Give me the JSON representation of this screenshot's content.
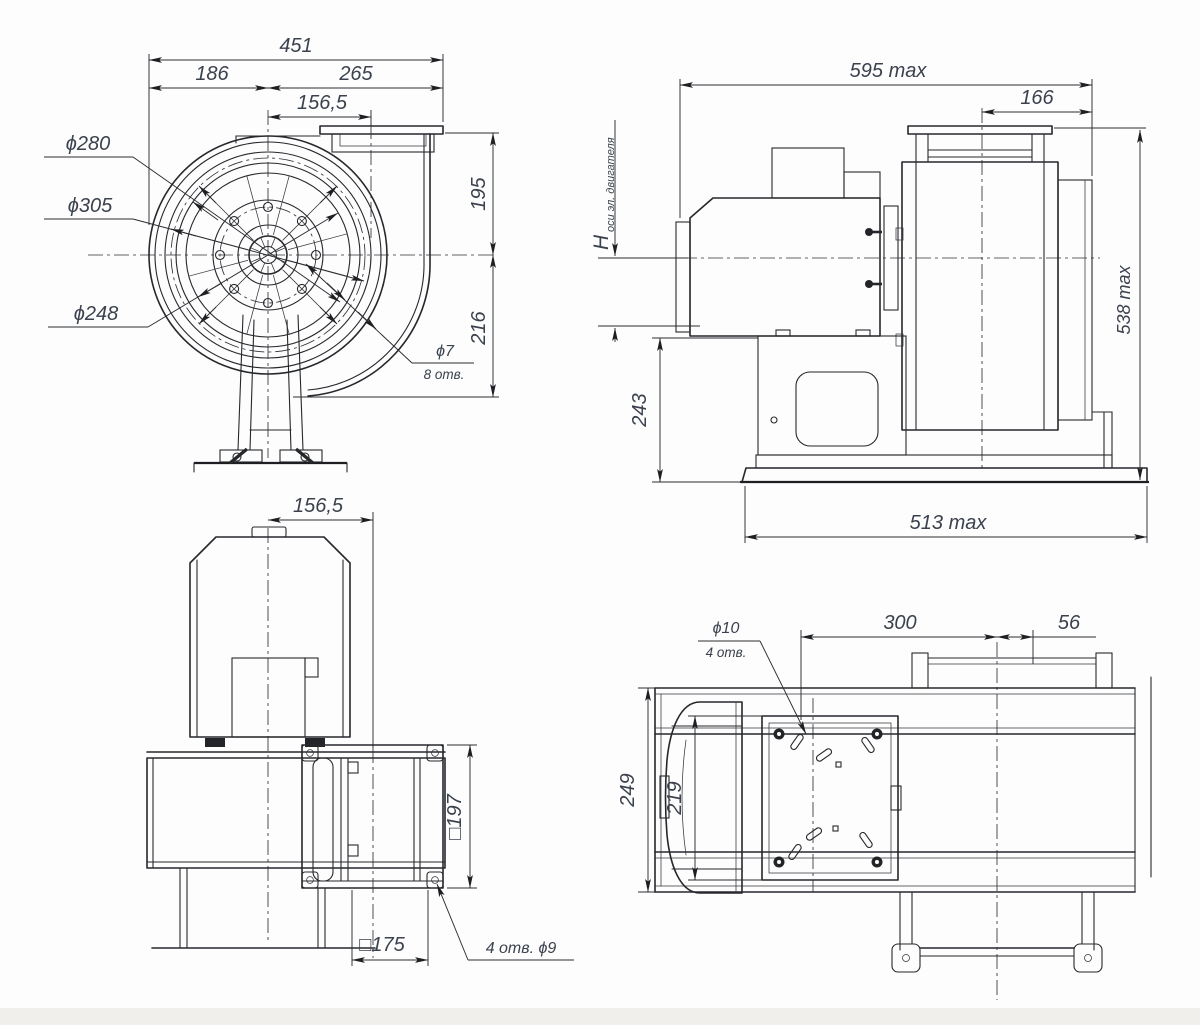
{
  "drawing": {
    "type": "fan-dimensional-drawing",
    "colors": {
      "line": "#26282c",
      "dim_text": "#3b414d",
      "background": "#fdfdfd",
      "footer": "#f0efec"
    },
    "views": {
      "front": {
        "dims": {
          "total_width": "451",
          "left_width": "186",
          "right_width": "265",
          "outlet_offset": "156,5",
          "d280": "ϕ280",
          "d305": "ϕ305",
          "d248": "ϕ248",
          "height_top": "195",
          "height_bottom": "216",
          "holes_d": "ϕ7",
          "holes_n": "8 отв."
        }
      },
      "side": {
        "dims": {
          "length_max": "595 max",
          "inlet_offset": "166",
          "axis_height_symbol": "H",
          "axis_height_sub": "оси эл. двигателя",
          "base_height": "243",
          "height_max": "538 max",
          "base_length": "513 max"
        }
      },
      "back": {
        "dims": {
          "outlet_offset": "156,5",
          "flange_size": "□197",
          "opening_size": "□175",
          "flange_holes": "4 отв.  ϕ9"
        }
      },
      "plan": {
        "dims": {
          "holes_d": "ϕ10",
          "holes_n": "4 отв.",
          "plate_length": "300",
          "collar_overhang": "56",
          "casing_depth": "249",
          "motor_width": "219"
        }
      }
    }
  }
}
